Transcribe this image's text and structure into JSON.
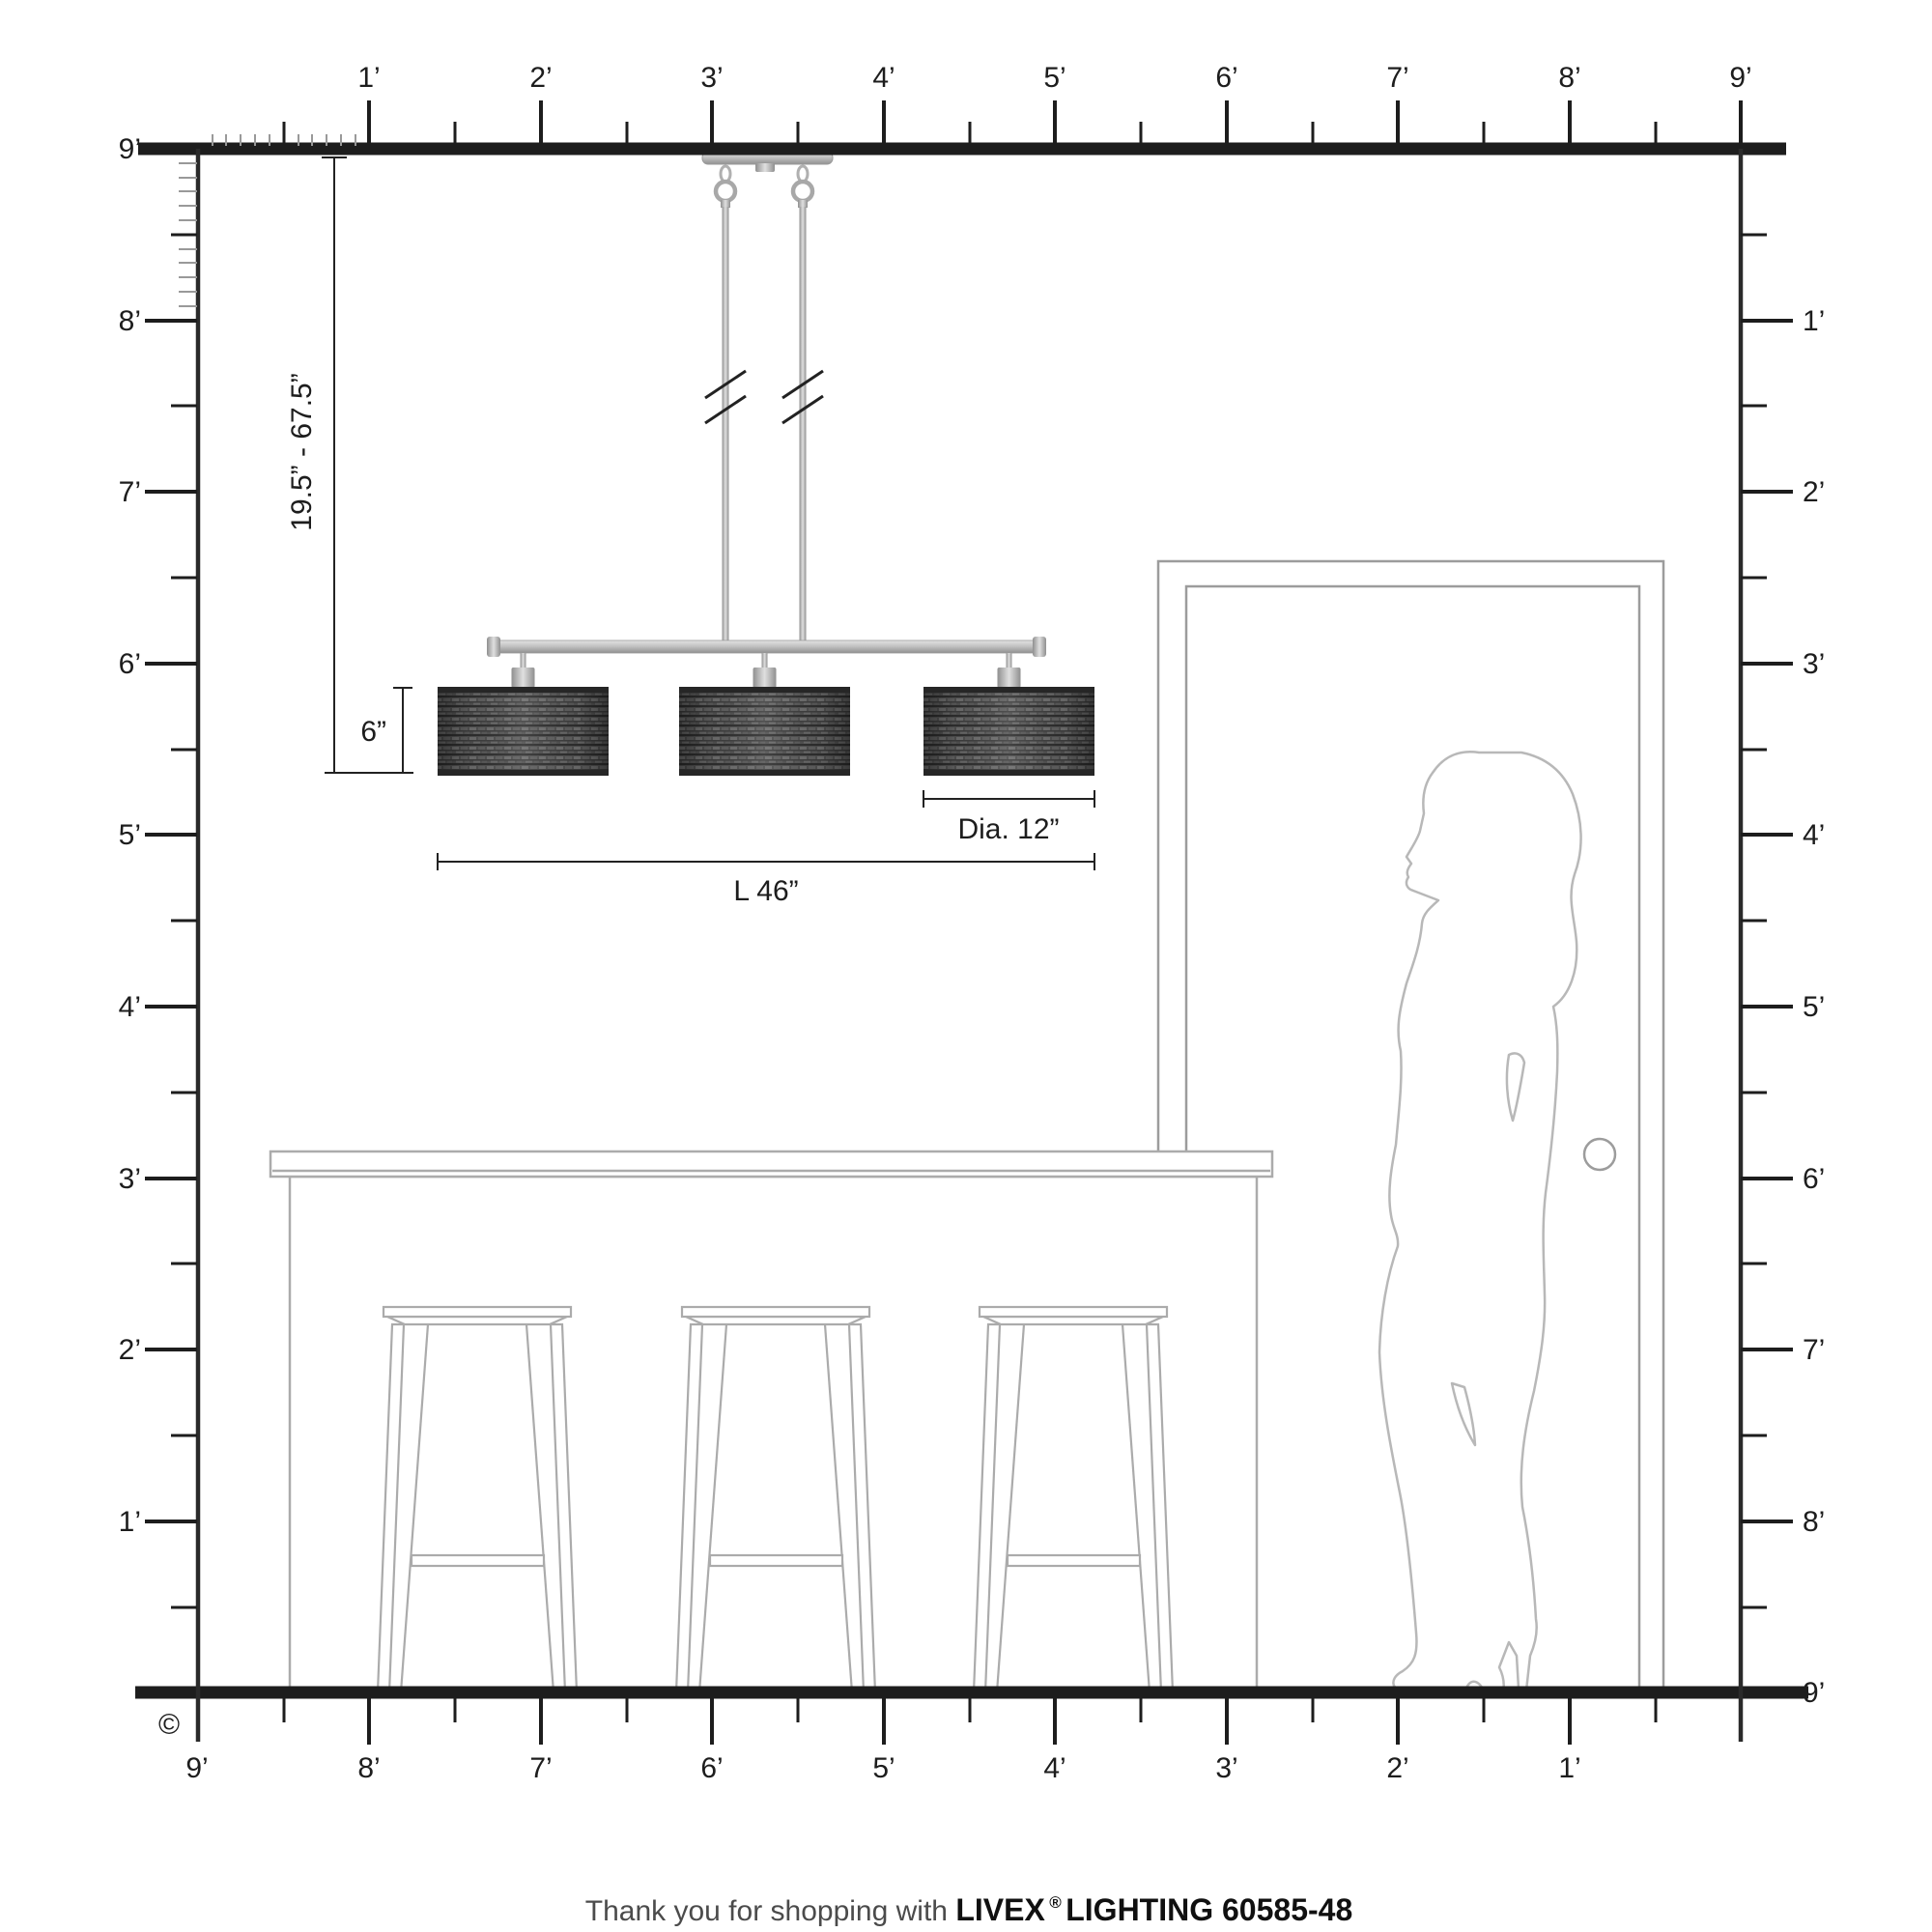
{
  "rulers": {
    "top": [
      "1’",
      "2’",
      "3’",
      "4’",
      "5’",
      "6’",
      "7’",
      "8’",
      "9’"
    ],
    "left": [
      "9’",
      "8’",
      "7’",
      "6’",
      "5’",
      "4’",
      "3’",
      "2’",
      "1’"
    ],
    "right": [
      "1’",
      "2’",
      "3’",
      "4’",
      "5’",
      "6’",
      "7’",
      "8’",
      "9’"
    ],
    "bottom": [
      "9’",
      "8’",
      "7’",
      "6’",
      "5’",
      "4’",
      "3’",
      "2’",
      "1’"
    ]
  },
  "dimensions": {
    "hang_range": "19.5” - 67.5”",
    "shade_height": "6”",
    "diameter": "Dia. 12”",
    "length": "L 46”"
  },
  "footer": {
    "prefix": "Thank you for shopping with ",
    "brand": "LIVEX",
    "reg": "®",
    "suffix": " LIGHTING 60585-48"
  },
  "copyright": "©",
  "colors": {
    "structure_line": "#1d1d1d",
    "furniture_line": "#ababab",
    "silhouette_line": "#b8b8b8",
    "metal_light": "#d6d6d6",
    "metal_dark": "#8f8f8f",
    "shade_base": "#4e4e4e",
    "shade_band": "#262626"
  }
}
